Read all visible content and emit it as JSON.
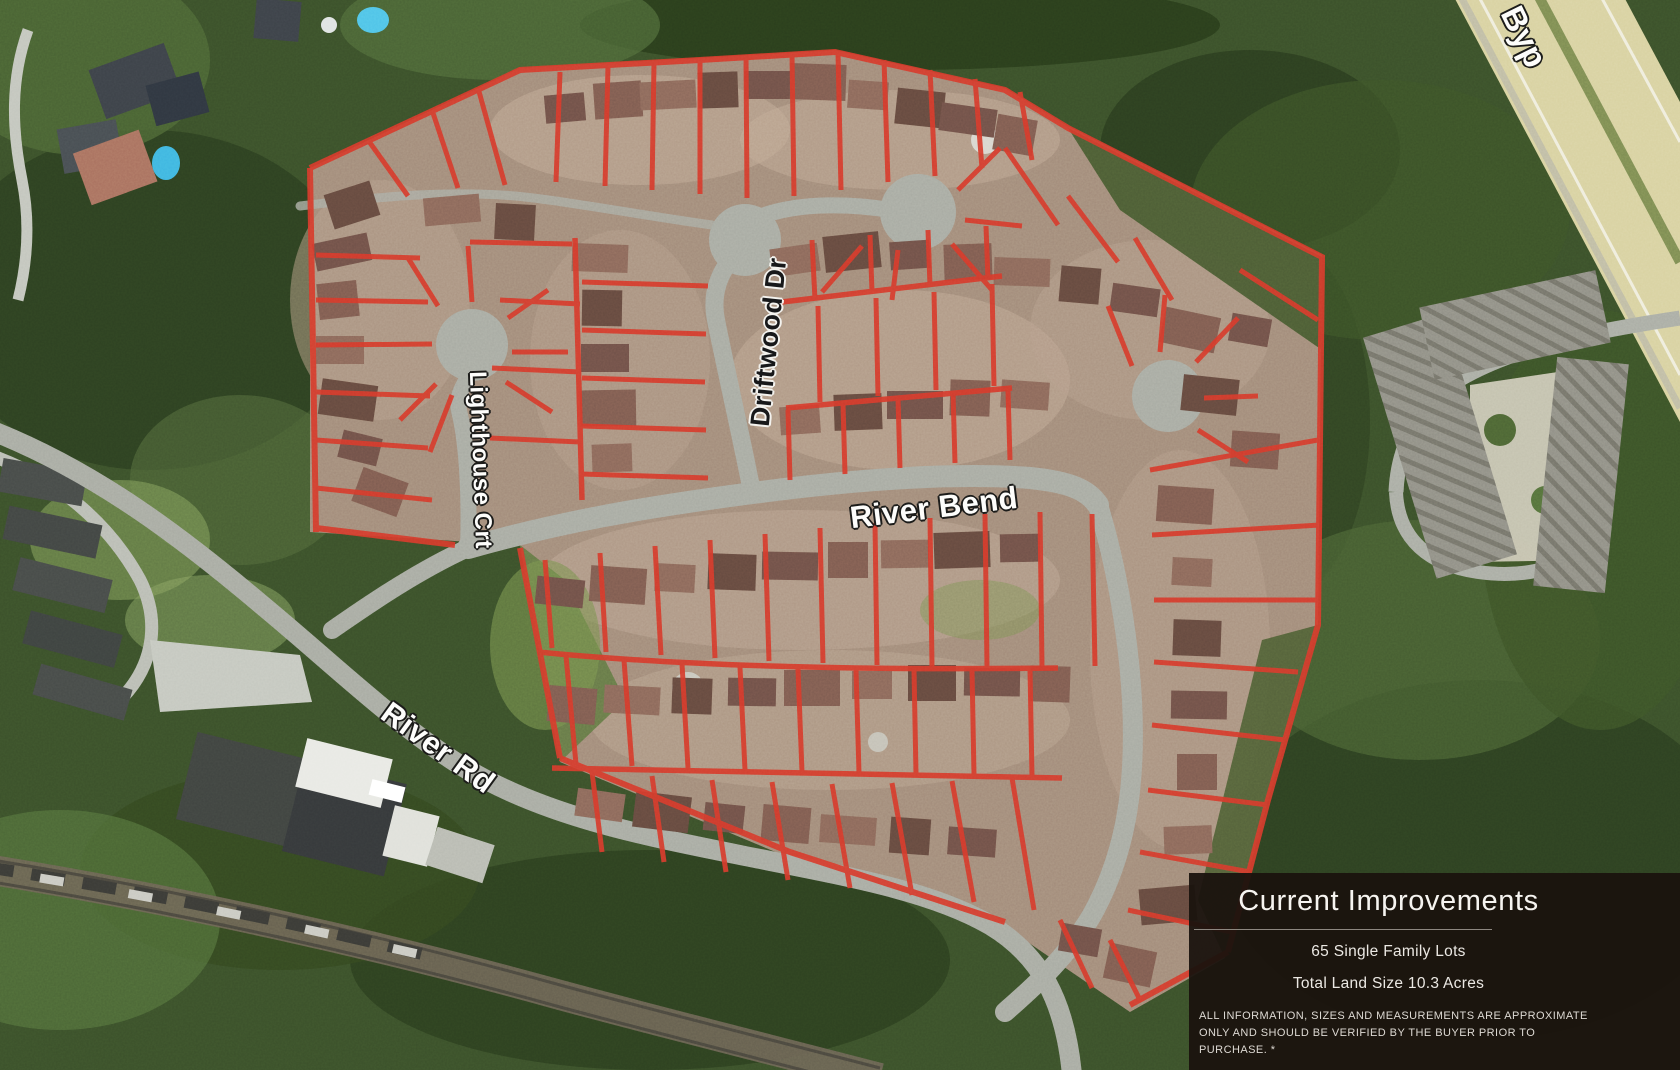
{
  "map": {
    "street_labels": {
      "driftwood": "Driftwood Dr",
      "lighthouse": "Lighthouse Crt",
      "river_bend": "River Bend",
      "river_rd": "River Rd",
      "bypass": "Byp"
    },
    "lot_outline_color": "#d5392b"
  },
  "info_panel": {
    "title": "Current Improvements",
    "facts": [
      "65 Single Family Lots",
      "Total Land Size 10.3 Acres"
    ],
    "disclaimer": "ALL INFORMATION, SIZES AND MEASUREMENTS ARE APPROXIMATE ONLY AND SHOULD BE VERIFIED BY THE BUYER PRIOR TO PURCHASE. *",
    "background_color": "#1a130e",
    "text_color": "#f2efea"
  }
}
